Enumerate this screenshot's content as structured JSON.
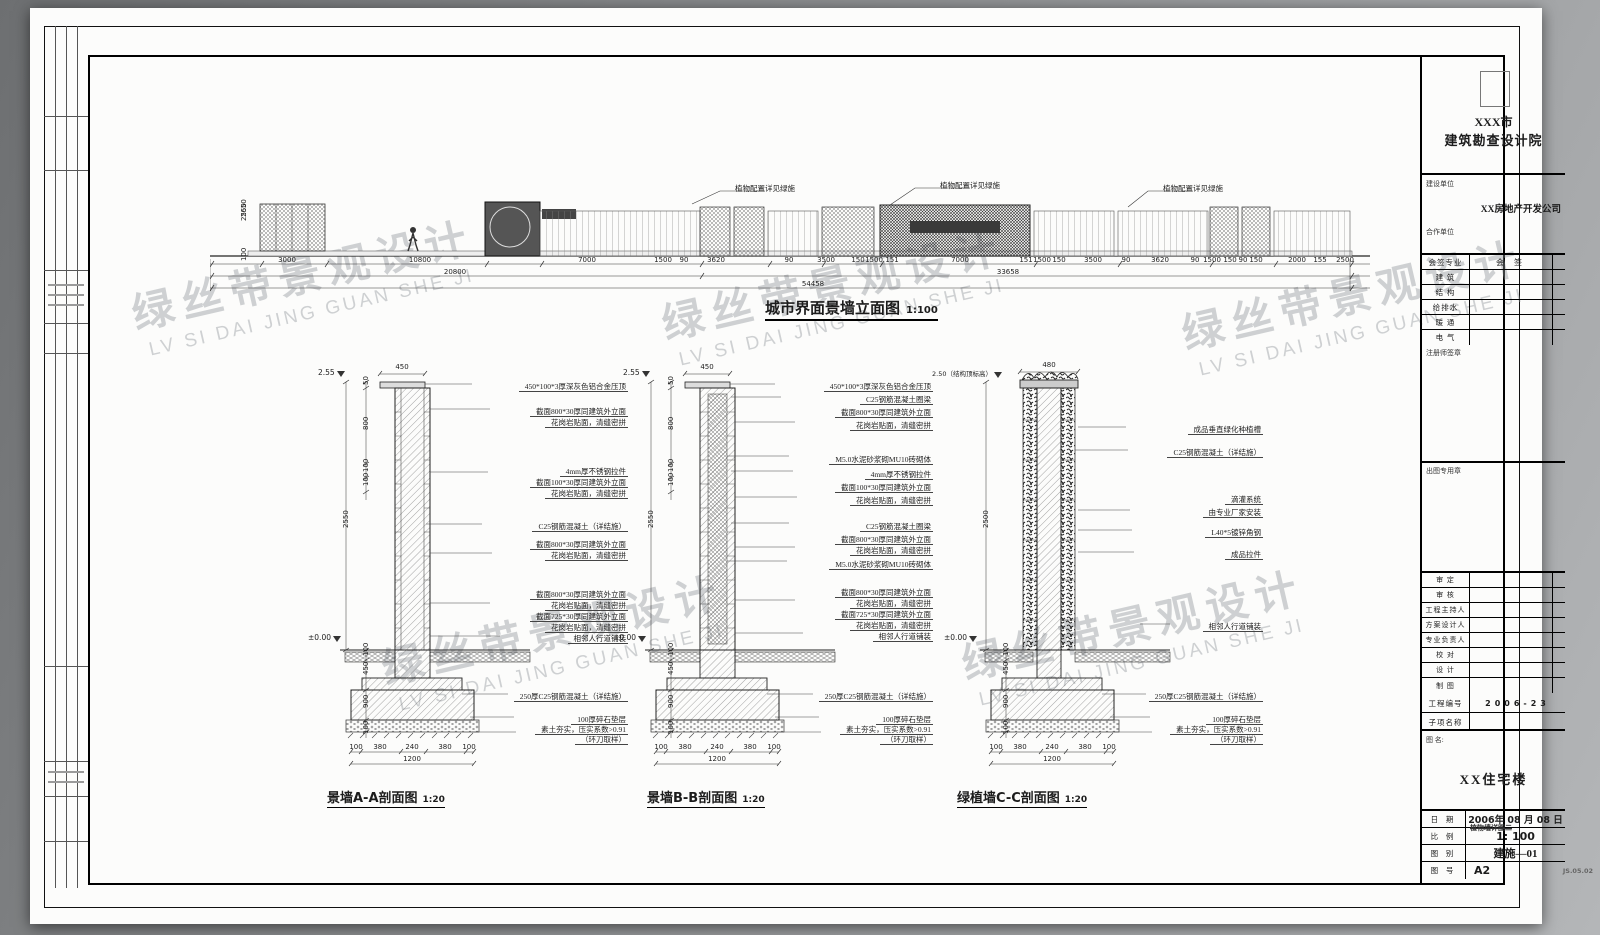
{
  "watermark": {
    "cn": "绿丝带景观设计",
    "en": "LV SI DAI JING GUAN SHE JI"
  },
  "elevation": {
    "title": "城市界面景墙立面图",
    "scale": "1:100",
    "plant_note": "植物配置详见绿施",
    "left_dims": [
      {
        "y": 40,
        "t": "2650"
      },
      {
        "y": 44,
        "t": "2550"
      },
      {
        "y": 84,
        "t": "100"
      }
    ],
    "dims_row1": [
      {
        "x": 77,
        "t": "3000"
      },
      {
        "x": 210,
        "t": "10800"
      },
      {
        "x": 377,
        "t": "7000"
      },
      {
        "x": 453,
        "t": "1500"
      },
      {
        "x": 474,
        "t": "90"
      },
      {
        "x": 506,
        "t": "3620"
      },
      {
        "x": 579,
        "t": "90"
      },
      {
        "x": 616,
        "t": "3500"
      },
      {
        "x": 648,
        "t": "150"
      },
      {
        "x": 664,
        "t": "1500"
      },
      {
        "x": 682,
        "t": "151"
      },
      {
        "x": 750,
        "t": "7000"
      },
      {
        "x": 816,
        "t": "151"
      },
      {
        "x": 832,
        "t": "1500"
      },
      {
        "x": 849,
        "t": "150"
      },
      {
        "x": 883,
        "t": "3500"
      },
      {
        "x": 916,
        "t": "90"
      },
      {
        "x": 950,
        "t": "3620"
      },
      {
        "x": 985,
        "t": "90"
      },
      {
        "x": 1002,
        "t": "1500"
      },
      {
        "x": 1020,
        "t": "150"
      },
      {
        "x": 1033,
        "t": "90"
      },
      {
        "x": 1046,
        "t": "150"
      },
      {
        "x": 1087,
        "t": "2000"
      },
      {
        "x": 1110,
        "t": "155"
      },
      {
        "x": 1135,
        "t": "2500"
      }
    ],
    "dims_row2": [
      {
        "x": 245,
        "t": "20800"
      },
      {
        "x": 798,
        "t": "33658"
      }
    ],
    "dims_row3": [
      {
        "x": 603,
        "t": "54458"
      }
    ]
  },
  "sections": {
    "a": {
      "title": "景墙A-A剖面图",
      "scale": "1:20",
      "top_width": "450",
      "level_top": "2.55",
      "level_ground": "±0.00",
      "overall": "2550",
      "left_dims": [
        {
          "y": 25,
          "t": "50"
        },
        {
          "y": 70,
          "t": "800"
        },
        {
          "y": 112,
          "t": "100"
        },
        {
          "y": 126,
          "t": "100"
        },
        {
          "y": 296,
          "t": "100"
        },
        {
          "y": 315,
          "t": "450"
        },
        {
          "y": 348,
          "t": "900"
        },
        {
          "y": 374,
          "t": "100"
        }
      ],
      "labels": [
        {
          "y": 12,
          "t": "450*100*3厚深灰色铝合金压顶"
        },
        {
          "y": 37,
          "t": "截面800*30厚同建筑外立面"
        },
        {
          "y": 48,
          "t": "花岗岩贴面，清缝密拼"
        },
        {
          "y": 97,
          "t": "4mm厚不锈钢拉件"
        },
        {
          "y": 108,
          "t": "截面100*30厚同建筑外立面"
        },
        {
          "y": 119,
          "t": "花岗岩贴面，清缝密拼"
        },
        {
          "y": 152,
          "t": "C25钢筋混凝土（详结施）"
        },
        {
          "y": 170,
          "t": "截面800*30厚同建筑外立面"
        },
        {
          "y": 181,
          "t": "花岗岩贴面，清缝密拼"
        },
        {
          "y": 220,
          "t": "截面800*30厚同建筑外立面"
        },
        {
          "y": 231,
          "t": "花岗岩贴面，清缝密拼"
        },
        {
          "y": 242,
          "t": "截面725*30厚同建筑外立面"
        },
        {
          "y": 253,
          "t": "花岗岩贴面，清缝密拼"
        },
        {
          "y": 264,
          "t": "相邻人行道铺装"
        },
        {
          "y": 322,
          "t": "250厚C25钢筋混凝土（详结施）"
        },
        {
          "y": 345,
          "t": "100厚碎石垫层"
        },
        {
          "y": 355,
          "t": "素土夯实，压实系数>0.91"
        },
        {
          "y": 365,
          "t": "（环刀取样）"
        }
      ],
      "bottom_dims": [
        {
          "x": 56,
          "t": "100"
        },
        {
          "x": 80,
          "t": "380"
        },
        {
          "x": 112,
          "t": "240"
        },
        {
          "x": 145,
          "t": "380"
        },
        {
          "x": 169,
          "t": "100"
        }
      ],
      "bottom_total": "1200"
    },
    "b": {
      "title": "景墙B-B剖面图",
      "scale": "1:20",
      "top_width": "450",
      "level_top": "2.55",
      "level_ground": "±0.00",
      "overall": "2550",
      "left_dims": [
        {
          "y": 25,
          "t": "50"
        },
        {
          "y": 70,
          "t": "800"
        },
        {
          "y": 112,
          "t": "100"
        },
        {
          "y": 126,
          "t": "100"
        },
        {
          "y": 296,
          "t": "100"
        },
        {
          "y": 315,
          "t": "450"
        },
        {
          "y": 348,
          "t": "900"
        },
        {
          "y": 374,
          "t": "100"
        }
      ],
      "labels": [
        {
          "y": 12,
          "t": "450*100*3厚深灰色铝合金压顶"
        },
        {
          "y": 25,
          "t": "C25钢筋混凝土圈梁"
        },
        {
          "y": 38,
          "t": "截面800*30厚同建筑外立面"
        },
        {
          "y": 51,
          "t": "花岗岩贴面，清缝密拼"
        },
        {
          "y": 85,
          "t": "M5.0水泥砂浆砌MU10砖砌体"
        },
        {
          "y": 100,
          "t": "4mm厚不锈钢拉件"
        },
        {
          "y": 113,
          "t": "截面100*30厚同建筑外立面"
        },
        {
          "y": 126,
          "t": "花岗岩贴面，清缝密拼"
        },
        {
          "y": 152,
          "t": "C25钢筋混凝土圈梁"
        },
        {
          "y": 165,
          "t": "截面800*30厚同建筑外立面"
        },
        {
          "y": 176,
          "t": "花岗岩贴面，清缝密拼"
        },
        {
          "y": 190,
          "t": "M5.0水泥砂浆砌MU10砖砌体"
        },
        {
          "y": 218,
          "t": "截面800*30厚同建筑外立面"
        },
        {
          "y": 229,
          "t": "花岗岩贴面，清缝密拼"
        },
        {
          "y": 240,
          "t": "截面725*30厚同建筑外立面"
        },
        {
          "y": 251,
          "t": "花岗岩贴面，清缝密拼"
        },
        {
          "y": 262,
          "t": "相邻人行道铺装"
        },
        {
          "y": 322,
          "t": "250厚C25钢筋混凝土（详结施）"
        },
        {
          "y": 345,
          "t": "100厚碎石垫层"
        },
        {
          "y": 355,
          "t": "素土夯实，压实系数>0.91"
        },
        {
          "y": 365,
          "t": "（环刀取样）"
        }
      ],
      "bottom_dims": [
        {
          "x": 56,
          "t": "100"
        },
        {
          "x": 80,
          "t": "380"
        },
        {
          "x": 112,
          "t": "240"
        },
        {
          "x": 145,
          "t": "380"
        },
        {
          "x": 169,
          "t": "100"
        }
      ],
      "bottom_total": "1200"
    },
    "c": {
      "title": "绿植墙C-C剖面图",
      "scale": "1:20",
      "top_width": "480",
      "level_top": "2.50（结构顶标高）",
      "level_ground": "±0.00",
      "overall": "2500",
      "left_dims": [
        {
          "y": 296,
          "t": "100"
        },
        {
          "y": 315,
          "t": "450"
        },
        {
          "y": 348,
          "t": "900"
        },
        {
          "y": 374,
          "t": "100"
        }
      ],
      "labels": [
        {
          "y": 55,
          "t": "成品垂直绿化种植槽"
        },
        {
          "y": 78,
          "t": "C25钢筋混凝土（详结施）"
        },
        {
          "y": 125,
          "t": "滴灌系统"
        },
        {
          "y": 138,
          "t": "由专业厂家安装"
        },
        {
          "y": 158,
          "t": "L40*5镀锌角钢"
        },
        {
          "y": 180,
          "t": "成品拉件"
        },
        {
          "y": 252,
          "t": "相邻人行道铺装"
        },
        {
          "y": 322,
          "t": "250厚C25钢筋混凝土（详结施）"
        },
        {
          "y": 345,
          "t": "100厚碎石垫层"
        },
        {
          "y": 355,
          "t": "素土夯实，压实系数>0.91"
        },
        {
          "y": 365,
          "t": "（环刀取样）"
        }
      ],
      "bottom_dims": [
        {
          "x": 66,
          "t": "100"
        },
        {
          "x": 90,
          "t": "380"
        },
        {
          "x": 122,
          "t": "240"
        },
        {
          "x": 155,
          "t": "380"
        },
        {
          "x": 179,
          "t": "100"
        }
      ],
      "bottom_total": "1200"
    }
  },
  "titleblock": {
    "institute_city": "XXX市",
    "institute": "建筑勘查设计院",
    "client_label": "建设单位",
    "client": "XX房地产开发公司",
    "partner_label": "合作单位",
    "sign_rows": [
      [
        "会签专业",
        "会 签"
      ],
      [
        "建 筑",
        ""
      ],
      [
        "结 构",
        ""
      ],
      [
        "给排水",
        ""
      ],
      [
        "暖 通",
        ""
      ],
      [
        "电 气",
        ""
      ]
    ],
    "reg_seal_label": "注册师签章",
    "out_seal_label": "出图专用章",
    "person_rows": [
      "审 定",
      "审 核",
      "工程主持人",
      "方案设计人",
      "专业负责人",
      "校 对",
      "设 计",
      "制 图"
    ],
    "project_no_label": "工程编号",
    "project_no": "2006-23",
    "subitem_label": "子项名称",
    "drawing_name_label": "图 名:",
    "drawing_name": "XX住宅楼",
    "date_label": "日 期",
    "date": "2006年 08 月 08 日",
    "scale_label": "比 例",
    "scale_strike": "植物墙详图二",
    "scale": "1: 100",
    "category_label": "图 别",
    "category": "建施—01",
    "no_label": "图 号",
    "no": "A2",
    "corner_code": "JS.05.02"
  }
}
